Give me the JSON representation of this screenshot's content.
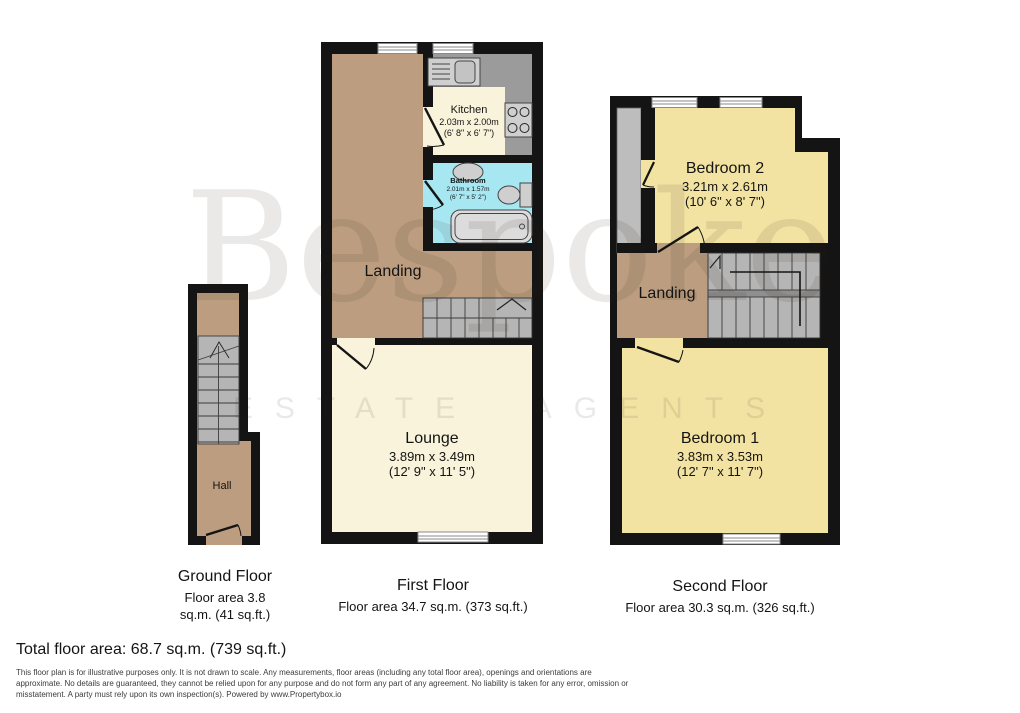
{
  "watermark": {
    "brand": "Bespoke",
    "tagline": "ESTATE AGENTS"
  },
  "floors": {
    "ground": {
      "title": "Ground Floor",
      "area_lines": [
        "Floor area 3.8",
        "sq.m. (41 sq.ft.)"
      ],
      "rooms": {
        "hall": {
          "name": "Hall"
        }
      }
    },
    "first": {
      "title": "First Floor",
      "area_line": "Floor area 34.7 sq.m. (373 sq.ft.)",
      "rooms": {
        "kitchen": {
          "name": "Kitchen",
          "size_metric": "2.03m x 2.00m",
          "size_imperial": "(6' 8\" x 6' 7\")"
        },
        "bathroom": {
          "name": "Bathroom",
          "size_metric": "2.01m x 1.57m",
          "size_imperial": "(6' 7\" x 5' 2\")"
        },
        "landing": {
          "name": "Landing"
        },
        "lounge": {
          "name": "Lounge",
          "size_metric": "3.89m x 3.49m",
          "size_imperial": "(12' 9\" x 11' 5\")"
        }
      }
    },
    "second": {
      "title": "Second Floor",
      "area_line": "Floor area 30.3 sq.m. (326 sq.ft.)",
      "rooms": {
        "bedroom2": {
          "name": "Bedroom 2",
          "size_metric": "3.21m x 2.61m",
          "size_imperial": "(10' 6\" x 8' 7\")"
        },
        "landing": {
          "name": "Landing"
        },
        "bedroom1": {
          "name": "Bedroom 1",
          "size_metric": "3.83m x 3.53m",
          "size_imperial": "(12' 7\" x 11' 7\")"
        }
      }
    }
  },
  "summary": {
    "total_area": "Total floor area: 68.7 sq.m. (739 sq.ft.)"
  },
  "disclaimer": [
    "This floor plan is for illustrative purposes only. It is not drawn to scale. Any measurements, floor areas (including any total floor area), openings and orientations are",
    "approximate. No details are guaranteed, they cannot be relied upon for any purpose and do not form any part of any agreement. No liability is taken for any error, omission or",
    "misstatement. A party must rely upon its own inspection(s). Powered by www.Propertybox.io"
  ],
  "icons": [
    "stairs-icon",
    "window-icon",
    "door-icon",
    "bath-icon",
    "toilet-icon",
    "basin-icon",
    "sink-drainer-icon",
    "hob-icon"
  ],
  "palette": {
    "wall": "#141414",
    "hall_landing_tan": "#bc9d7f",
    "living_cream": "#f8f3da",
    "bedroom_yellow": "#f3e3a2",
    "bathroom_blue": "#a6e7f2",
    "counter_gray": "#9b9b9b",
    "stairs_gray": "#b5b5b5",
    "watermark_gray": "#e9e7e3"
  }
}
